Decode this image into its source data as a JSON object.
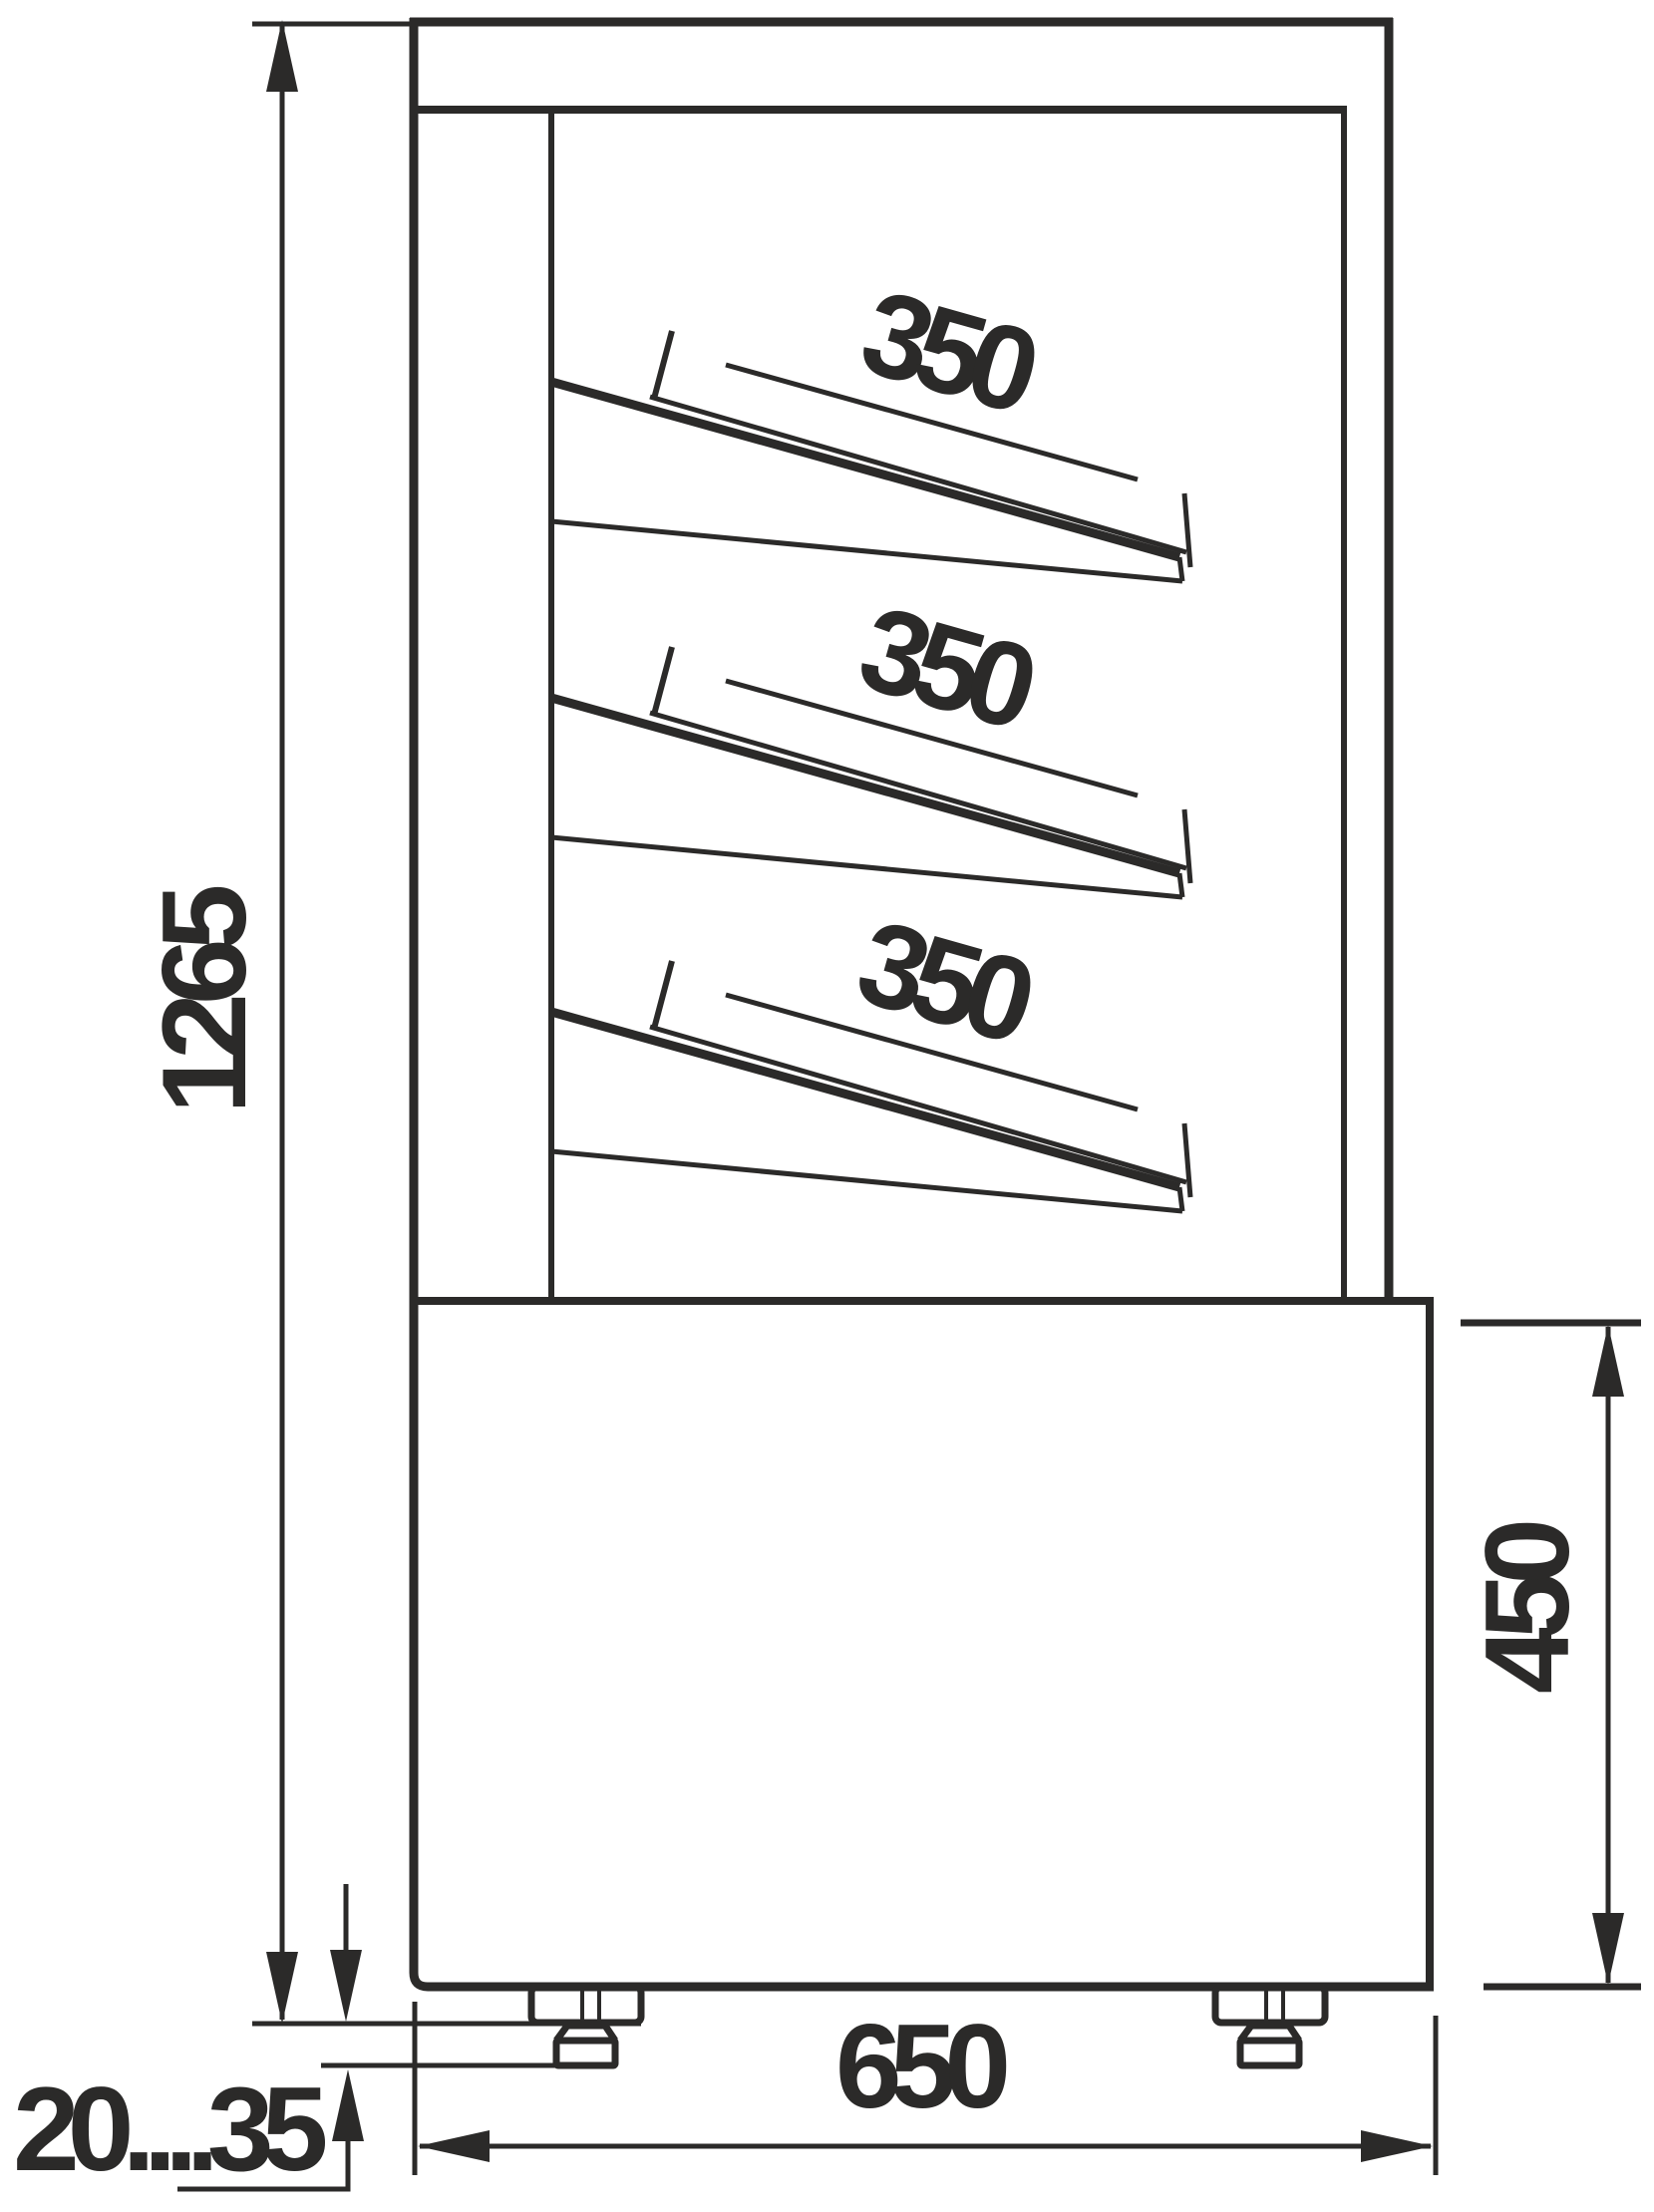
{
  "colors": {
    "line": "#2b2a29",
    "background": "#ffffff"
  },
  "dimensions": {
    "overall_height": "1265",
    "shelf_labels": [
      "350",
      "350",
      "350"
    ],
    "base_height": "450",
    "overall_depth": "650",
    "leg_adjustment_range": "20....35"
  }
}
